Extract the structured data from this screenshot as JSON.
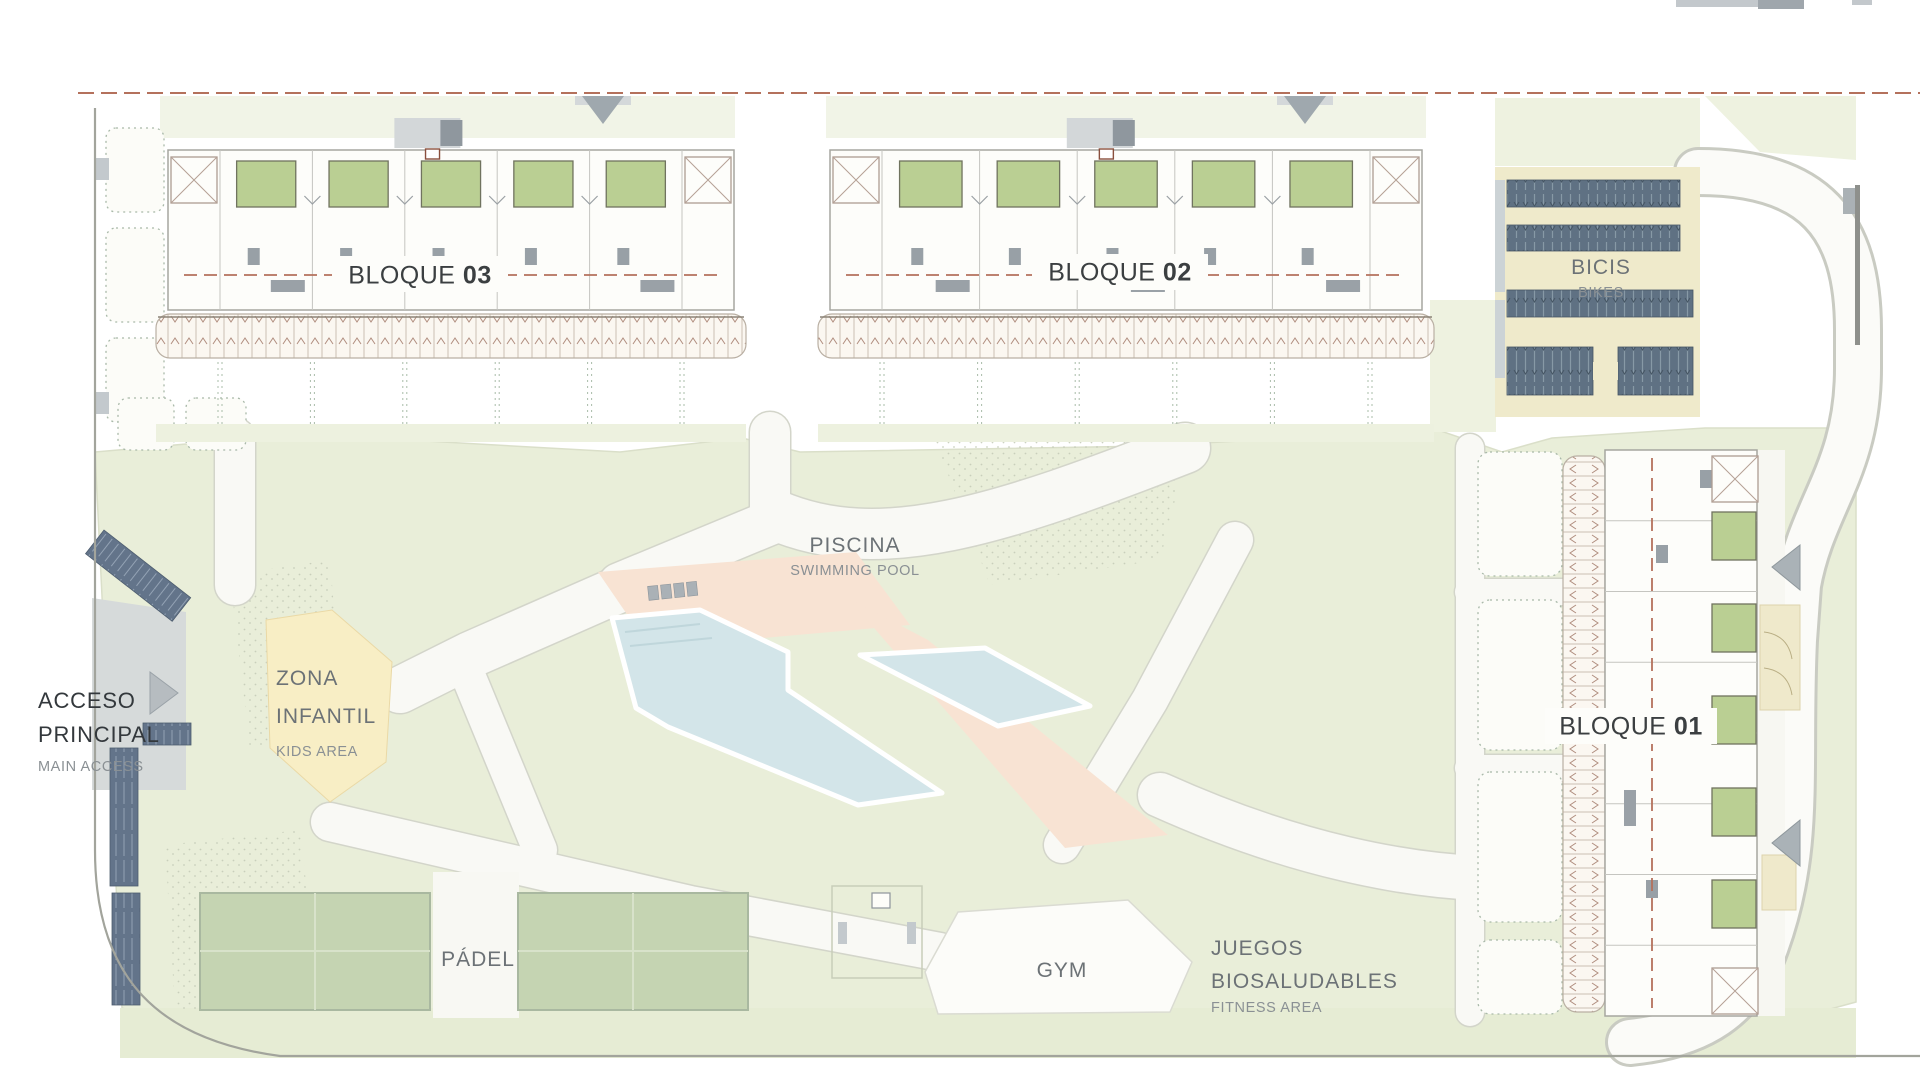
{
  "blocks": [
    {
      "id": "03",
      "label": "BLOQUE",
      "number": "03"
    },
    {
      "id": "02",
      "label": "BLOQUE",
      "number": "02"
    },
    {
      "id": "01",
      "label": "BLOQUE",
      "number": "01"
    }
  ],
  "areas": {
    "bikes": {
      "label": "BICIS",
      "sublabel": "BIKES"
    },
    "pool": {
      "label": "PISCINA",
      "sublabel": "SWIMMING POOL"
    },
    "kids": {
      "line1": "ZONA",
      "line2": "INFANTIL",
      "sublabel": "KIDS AREA"
    },
    "access": {
      "line1": "ACCESO",
      "line2": "PRINCIPAL",
      "sublabel": "MAIN ACCESS"
    },
    "padel": {
      "label": "PÁDEL"
    },
    "gym": {
      "label": "GYM"
    },
    "fitness": {
      "line1": "JUEGOS",
      "line2": "BIOSALUDABLES",
      "sublabel": "FITNESS AREA"
    }
  },
  "colors": {
    "boundary_dashed": "#b4715c",
    "landscape_green": "#e9eed9",
    "patio_green": "#bacf93",
    "pool_water": "#d3e5e9",
    "pool_deck": "#f8e3d3",
    "kids_yellow": "#f8eec5",
    "bike_rack_blue": "#5f7183",
    "label_dark": "#3b3f41",
    "label_gray": "#6c7276",
    "label_light_gray": "#8a9094"
  }
}
